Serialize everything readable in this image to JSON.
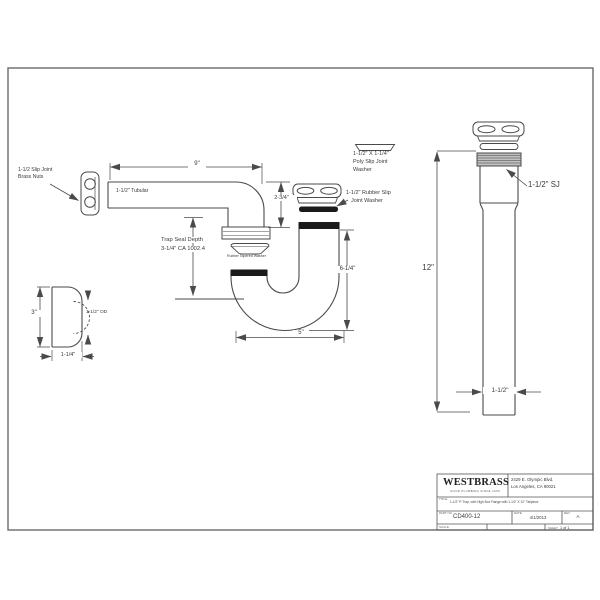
{
  "page": {
    "background": "#ffffff",
    "line_color": "#4a4a4a",
    "rubber_color": "#1a1a1a"
  },
  "drawing": {
    "labels": {
      "brass_nuts_1": "1-1/2 Slip Joint",
      "brass_nuts_2": "Brass Nuts",
      "tubular": "1-1/2\" Tubular",
      "trap_seal_1": "Trap Seal Depth",
      "trap_seal_2": "3-1/4\" CA 1002.4",
      "tapered_washer": "Rubber Tapered Washer",
      "poly_washer_1": "1-1/2\" X 1-1/4\"",
      "poly_washer_2": "Poly Slip Joint",
      "poly_washer_3": "Washer",
      "rubber_washer_1": "1-1/2\" Rubber Slip",
      "rubber_washer_2": "Joint Washer",
      "od": "1-1/2\" OD",
      "sj": "1-1/2\" SJ"
    },
    "dimensions": {
      "arm_length": "9\"",
      "drop": "2-3/4\"",
      "trap_height": "6-1/4\"",
      "trap_width": "5\"",
      "flange_height": "3\"",
      "flange_depth": "1-1/4\"",
      "tailpiece_length": "12\"",
      "tailpiece_diameter": "1-1/2\""
    }
  },
  "title_block": {
    "logo": "WESTBRASS",
    "tagline": "GOOD PLUMBING SINCE 1935",
    "address_1": "2429 E. Olympic Blvd.",
    "address_2": "Los Angeles, CA 90021",
    "title_label": "TITLE:",
    "title_value": "1-1/2\" P-Trap, with High Box Flange with 1-1/2\" X 12\" Tailpiece",
    "part_label": "PART NO.",
    "part_value": "CD400-12",
    "date_label": "DATE",
    "date_value": "4/1/2013",
    "rev_label": "REV",
    "rev_value": "A",
    "scale_label": "SCALE",
    "sheet_label": "SHEET",
    "sheet_value": "1 of 1"
  }
}
